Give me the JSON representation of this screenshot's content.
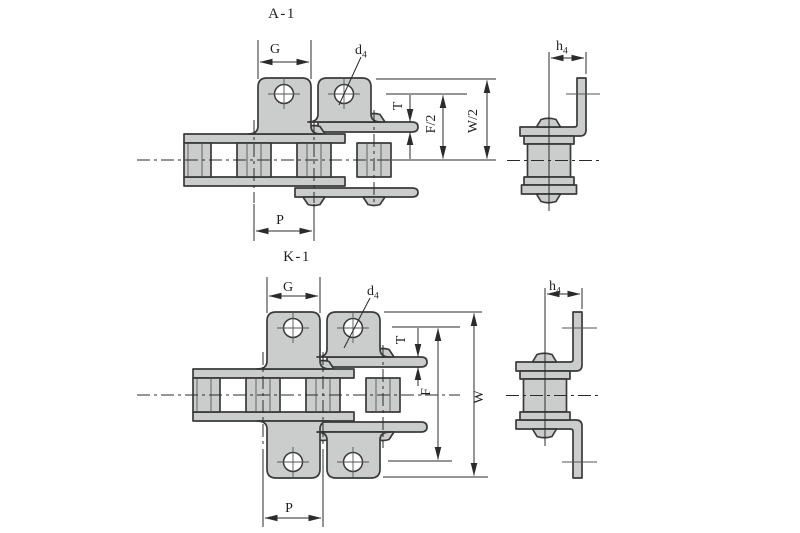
{
  "drawing": {
    "background": "#ffffff",
    "line_color": "#3a3a3a",
    "dim_color": "#2b2b2b",
    "part_fill": "#cbcdcc",
    "views": {
      "a1": {
        "title": "A-1",
        "dim_g": "G",
        "dim_d4_base": "d",
        "dim_d4_sub": "4",
        "dim_t": "T",
        "dim_f_half": "F/2",
        "dim_w_half": "W/2",
        "dim_p": "P",
        "dim_h4_base": "h",
        "dim_h4_sub": "4"
      },
      "k1": {
        "title": "K-1",
        "dim_g": "G",
        "dim_d4_base": "d",
        "dim_d4_sub": "4",
        "dim_t": "T",
        "dim_f": "F",
        "dim_w": "W",
        "dim_p": "P",
        "dim_h4_base": "h",
        "dim_h4_sub": "4"
      }
    }
  }
}
